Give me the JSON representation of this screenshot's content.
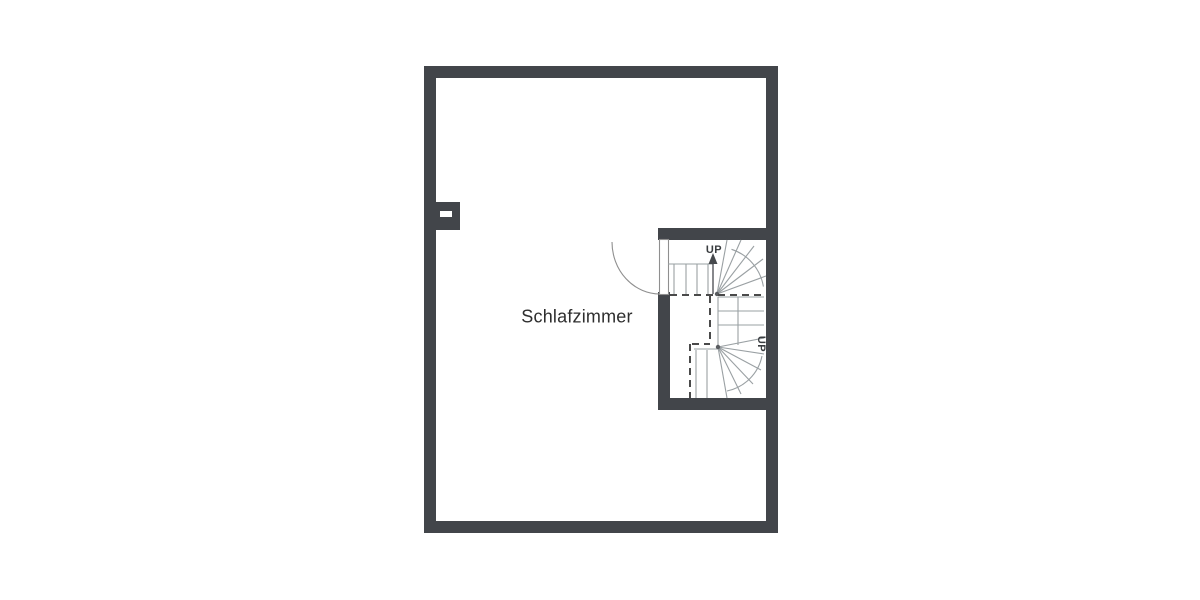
{
  "floorplan": {
    "room": {
      "label": "Schlafzimmer"
    },
    "stairs": {
      "upper_flight_label": "UP",
      "lower_flight_label": "UP"
    },
    "colors": {
      "wall": "#42454a",
      "stair-line": "#9aa0a3",
      "dash": "#4a4a4a",
      "text": "#2e2e2e",
      "door": "#8f8f8f",
      "bg": "#ffffff"
    }
  }
}
